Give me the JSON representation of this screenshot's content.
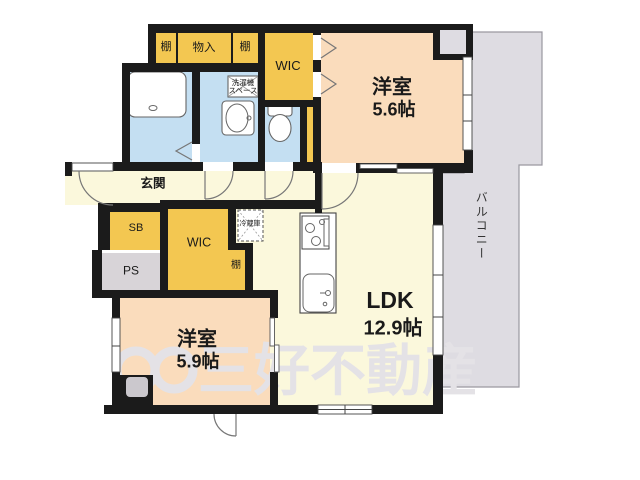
{
  "colors": {
    "wall": "#1b1b1b",
    "peach": "#fadcbc",
    "cream": "#fbf8dc",
    "blue": "#c4dff2",
    "yellow": "#f3c751",
    "ps": "#d8d4d8",
    "balcony": "#dedce2",
    "pillar": "#cbc8cd",
    "line": "#777777",
    "fixture": "#666666",
    "watermark": "#e4e2e6",
    "text": "#1a1a1a"
  },
  "rooms": {
    "bedroom1": {
      "name": "洋室",
      "size": "5.6帖"
    },
    "bedroom2": {
      "name": "洋室",
      "size": "5.9帖"
    },
    "ldk": {
      "name": "LDK",
      "size": "12.9帖"
    },
    "balcony": {
      "label": "バルコニー"
    },
    "entrance": {
      "label": "玄関"
    },
    "wic_top": {
      "label": "WIC"
    },
    "wic_lower": {
      "label": "WIC"
    },
    "shoe_box": {
      "label": "SB"
    },
    "pipe_shaft": {
      "label": "PS"
    },
    "shelf_top_left": {
      "label": "棚"
    },
    "closet_top": {
      "label": "物入"
    },
    "shelf_top_right": {
      "label": "棚"
    },
    "shelf_side": {
      "label": "棚"
    },
    "refrigerator": {
      "label": "冷蔵庫"
    },
    "laundry": {
      "line1": "洗濯機",
      "line2": "スペース"
    }
  },
  "watermark": {
    "text": "三好不動産"
  }
}
